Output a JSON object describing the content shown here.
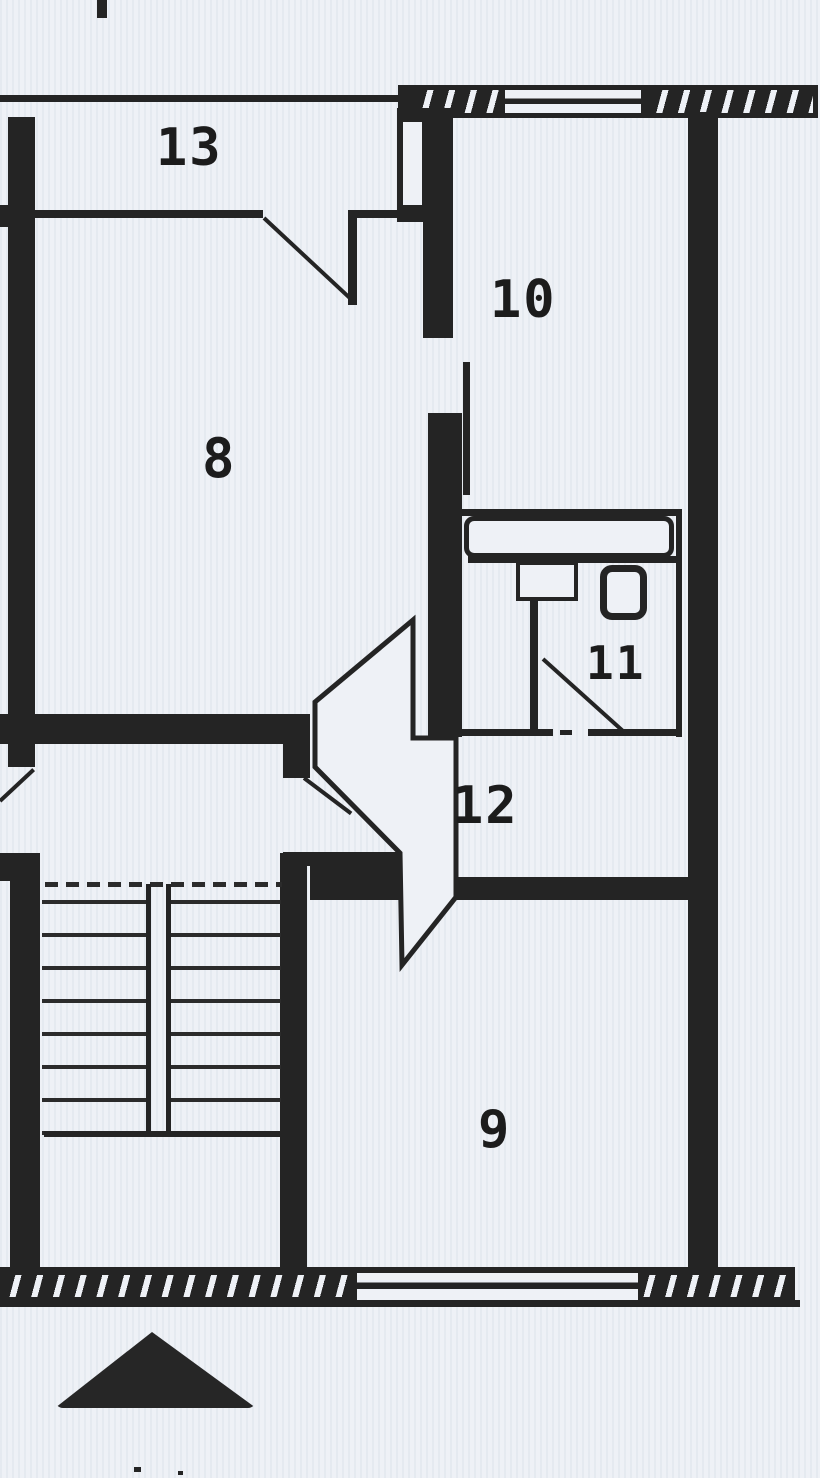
{
  "title": "Scanned apartment floor plan",
  "rooms": {
    "r13": {
      "label": "13"
    },
    "r10": {
      "label": "10"
    },
    "r8": {
      "label": "8"
    },
    "r11": {
      "label": "11"
    },
    "r12": {
      "label": "12"
    },
    "r9": {
      "label": "9"
    }
  },
  "fixtures": {
    "bathtub": "bathtub",
    "sink": "sink",
    "toilet": "toilet",
    "staircase": "staircase",
    "entrance_arrow": "entrance-arrow",
    "north_marker": "triangle-marker"
  },
  "colors": {
    "ink": "#242424",
    "paper": "#eef1f6"
  }
}
